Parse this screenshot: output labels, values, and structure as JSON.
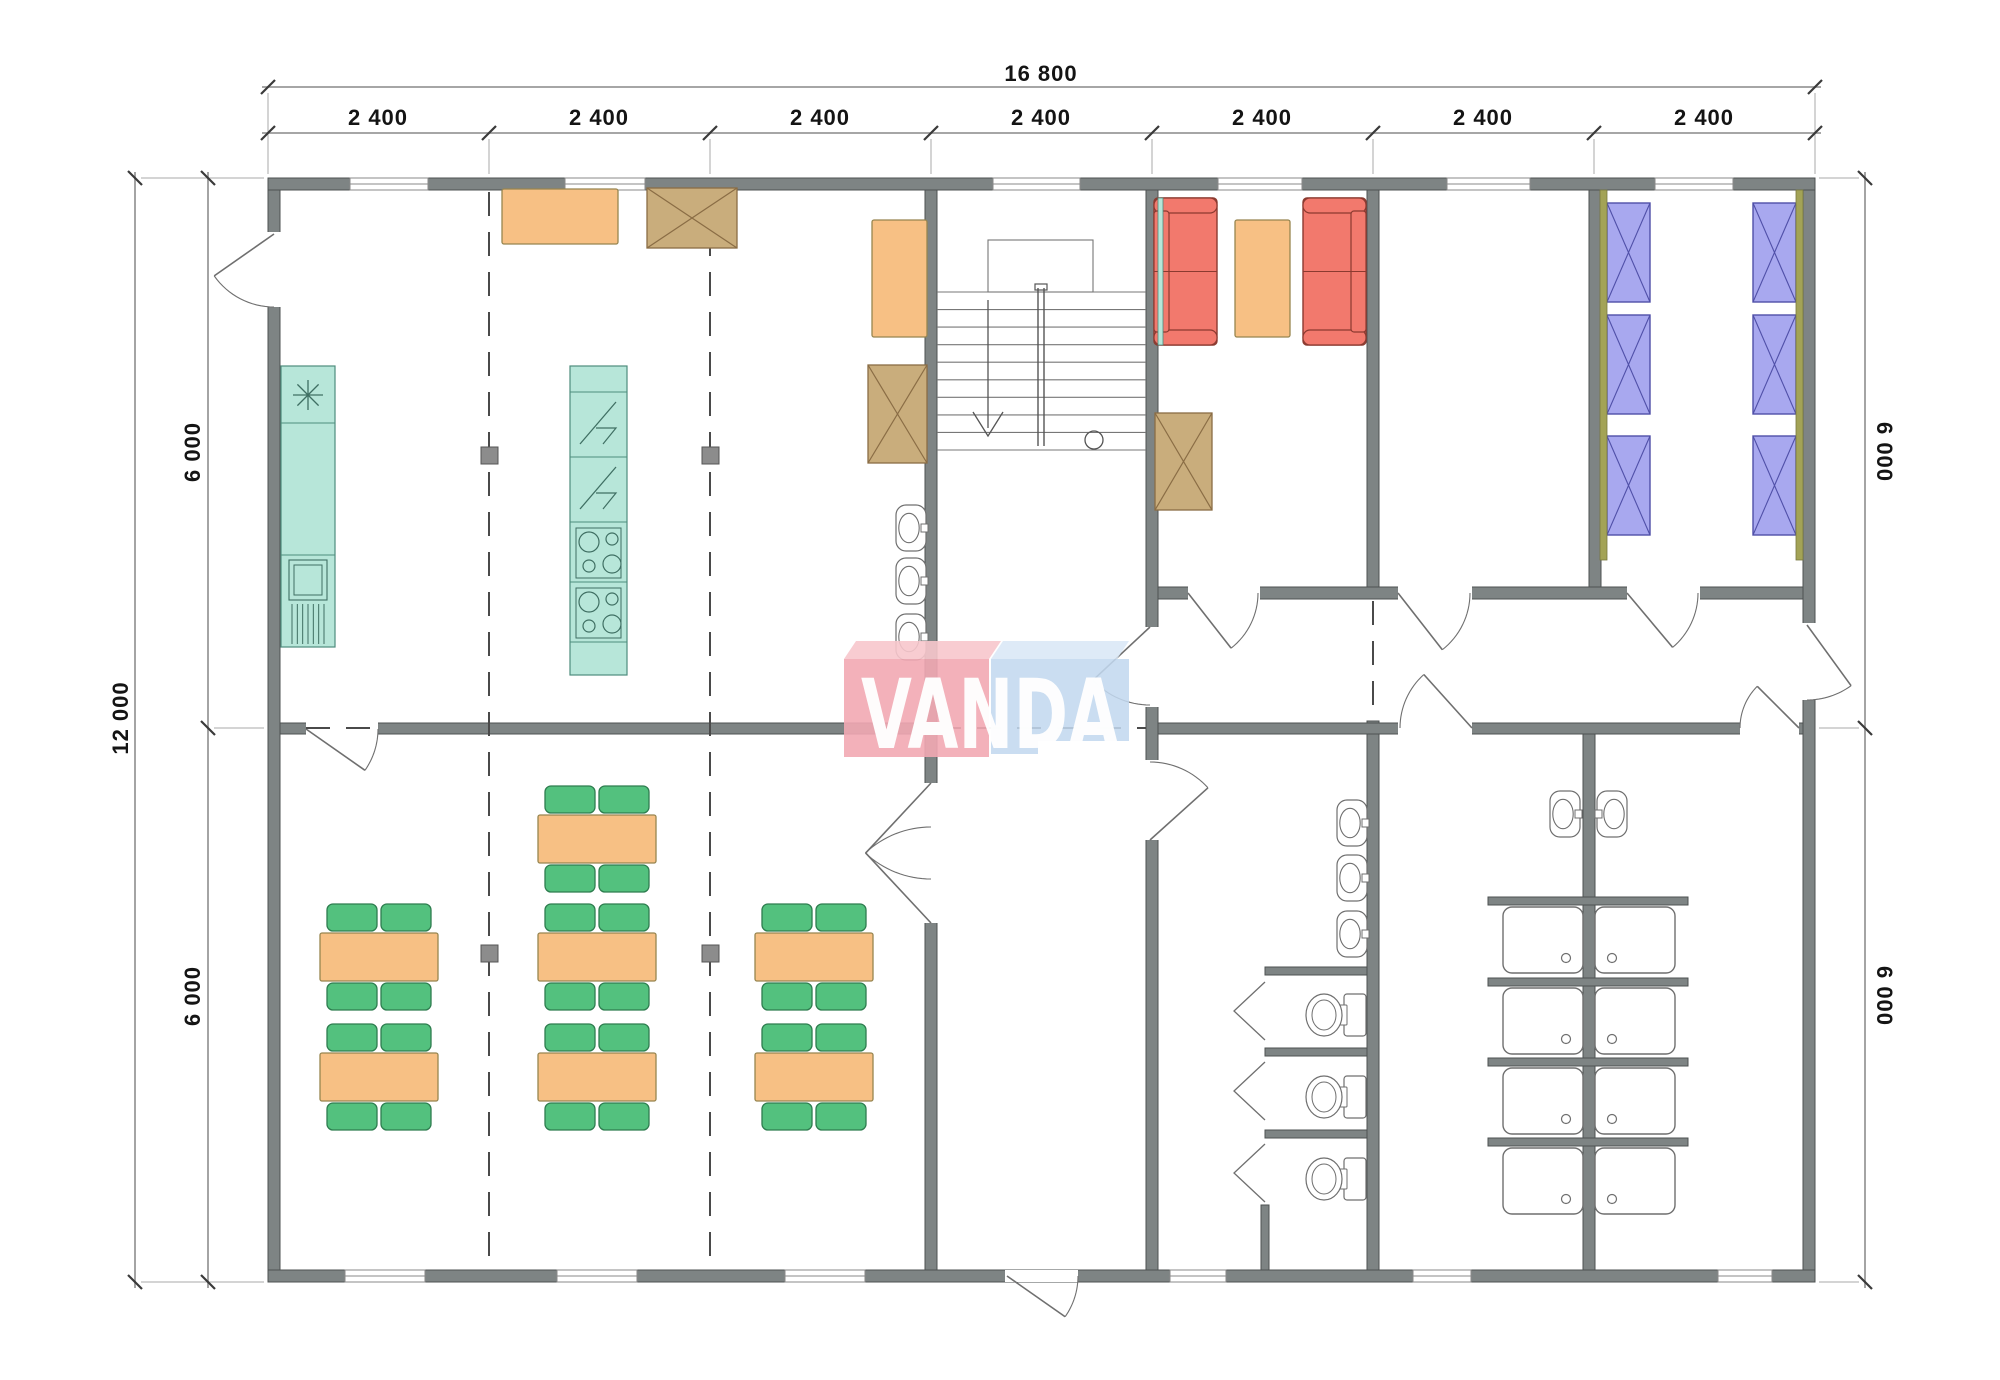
{
  "watermark": {
    "text": "VANDA",
    "pink": "#f2a9b2",
    "pink_top": "#f7c6cc",
    "blue": "#c2d8ef",
    "blue_top": "#d9e7f6",
    "letter_color": "#ffffff"
  },
  "dimensions": {
    "total_width": "16 800",
    "bays": [
      "2 400",
      "2 400",
      "2 400",
      "2 400",
      "2 400",
      "2 400",
      "2 400"
    ],
    "total_height": "12 000",
    "halves": [
      "6 000",
      "6 000",
      "6 000",
      "6 000"
    ]
  },
  "colors": {
    "wall": "#7e8484",
    "wall_stroke": "#4d5252",
    "fixture": "#6f6f6f",
    "teal": "#b7e6d9",
    "teal_stroke": "#4e8d7d",
    "orange": "#f7c084",
    "orange_stroke": "#97854f",
    "green": "#53c17e",
    "green_stroke": "#2e7d4f",
    "red": "#f2796d",
    "red_stroke": "#8b3a30",
    "blue": "#a8a8ef",
    "blue_stroke": "#5050a8",
    "tan": "#c9ad7c",
    "tan_stroke": "#8a6d45",
    "olive": "#a3a356",
    "olive_stroke": "#77773f",
    "axis": "#4a4a4a",
    "marker": "#8c8c8c",
    "dim_line": "#9a9a9a",
    "dim_tick": "#3a3a3a",
    "witness": "#aaaaaa"
  },
  "plan": {
    "bg": [
      268,
      178,
      1547,
      1104
    ],
    "walls": [
      [
        268,
        178,
        1547,
        12
      ],
      [
        268,
        1270,
        1547,
        12
      ],
      [
        268,
        190,
        12,
        1080
      ],
      [
        1803,
        190,
        12,
        1080
      ],
      [
        925,
        190,
        12,
        1080
      ],
      [
        1146,
        190,
        12,
        1080
      ],
      [
        1367,
        190,
        12,
        409
      ],
      [
        1367,
        721,
        12,
        549
      ],
      [
        1589,
        190,
        12,
        409
      ],
      [
        1583,
        733,
        12,
        537
      ],
      [
        280,
        723,
        645,
        11
      ],
      [
        1158,
        587,
        645,
        12
      ],
      [
        1158,
        723,
        645,
        11
      ],
      [
        1265,
        967,
        102,
        8
      ],
      [
        1265,
        1048,
        102,
        8
      ],
      [
        1265,
        1130,
        102,
        8
      ],
      [
        1261,
        1205,
        8,
        65
      ],
      [
        1488,
        897,
        200,
        8
      ],
      [
        1488,
        978,
        200,
        8
      ],
      [
        1488,
        1058,
        200,
        8
      ],
      [
        1488,
        1138,
        200,
        8
      ]
    ],
    "gaps": [
      [
        266,
        232,
        16,
        75
      ],
      [
        1801,
        623,
        16,
        77
      ],
      [
        306,
        721,
        72,
        15
      ],
      [
        923,
        783,
        16,
        140
      ],
      [
        1144,
        627,
        16,
        80
      ],
      [
        1144,
        760,
        16,
        80
      ],
      [
        1188,
        585,
        72,
        16
      ],
      [
        1398,
        585,
        74,
        16
      ],
      [
        1627,
        585,
        73,
        16
      ],
      [
        1398,
        721,
        74,
        15
      ],
      [
        1740,
        721,
        59,
        15
      ],
      [
        1005,
        1270,
        73,
        12
      ]
    ],
    "windows": [
      [
        350,
        178,
        78,
        12
      ],
      [
        565,
        178,
        80,
        12
      ],
      [
        993,
        178,
        87,
        12
      ],
      [
        1218,
        178,
        84,
        12
      ],
      [
        1447,
        178,
        83,
        12
      ],
      [
        1655,
        178,
        78,
        12
      ],
      [
        345,
        1270,
        80,
        12
      ],
      [
        557,
        1270,
        80,
        12
      ],
      [
        785,
        1270,
        80,
        12
      ],
      [
        1170,
        1270,
        56,
        12
      ],
      [
        1413,
        1270,
        58,
        12
      ],
      [
        1718,
        1270,
        54,
        12
      ]
    ],
    "doors": [
      [
        274,
        234,
        73,
        90,
        145
      ],
      [
        306,
        729,
        72,
        0,
        35
      ],
      [
        931,
        783,
        96,
        90,
        133
      ],
      [
        931,
        923,
        96,
        -90,
        -133
      ],
      [
        1150,
        627,
        78,
        90,
        137
      ],
      [
        1150,
        840,
        78,
        -90,
        -42
      ],
      [
        1188,
        593,
        70,
        0,
        52
      ],
      [
        1398,
        593,
        72,
        0,
        52
      ],
      [
        1627,
        593,
        71,
        0,
        50
      ],
      [
        1472,
        728,
        72,
        180,
        228
      ],
      [
        1807,
        625,
        75,
        90,
        54
      ],
      [
        1799,
        728,
        59,
        180,
        225
      ],
      [
        1007,
        1276,
        71,
        0,
        35
      ]
    ],
    "axes": [
      [
        489,
        192,
        489,
        1268
      ],
      [
        710,
        192,
        710,
        1268
      ],
      [
        1373,
        601,
        1373,
        719
      ],
      [
        937,
        728,
        1146,
        728
      ],
      [
        306,
        728,
        378,
        728
      ]
    ],
    "markers": [
      [
        481,
        447
      ],
      [
        702,
        447
      ],
      [
        481,
        945
      ],
      [
        702,
        945
      ]
    ],
    "stairs": {
      "x1": 937,
      "x2": 1146,
      "flight_top": 292,
      "bottom": 450,
      "treads": 9,
      "landing": [
        988,
        240,
        105,
        52
      ],
      "stringer_x": 1041,
      "arrow_x": 988,
      "circle": [
        1094,
        440,
        9
      ]
    },
    "furniture": {
      "tables": [
        [
          320,
          933
        ],
        [
          320,
          1053
        ],
        [
          538,
          815
        ],
        [
          538,
          933
        ],
        [
          538,
          1053
        ],
        [
          755,
          933
        ],
        [
          755,
          1053
        ]
      ],
      "table_size": [
        118,
        48
      ],
      "chair_size": [
        50,
        27
      ],
      "orange_boxes": [
        [
          502,
          189,
          116,
          55
        ],
        [
          872,
          220,
          55,
          117
        ],
        [
          1235,
          220,
          55,
          117
        ]
      ],
      "xboxes": [
        [
          647,
          188,
          90,
          60
        ],
        [
          868,
          365,
          59,
          98
        ],
        [
          1155,
          413,
          57,
          97
        ]
      ],
      "sofas": [
        {
          "x": 1154,
          "y": 198,
          "back": "left"
        },
        {
          "x": 1303,
          "y": 198,
          "back": "right"
        }
      ],
      "sofa_size": [
        63,
        147
      ],
      "beds": [
        [
          1607,
          203
        ],
        [
          1607,
          315
        ],
        [
          1607,
          436
        ],
        [
          1753,
          203
        ],
        [
          1753,
          315
        ],
        [
          1753,
          436
        ]
      ],
      "bed_size": [
        43,
        99
      ],
      "olive_strips": [
        [
          1600,
          190,
          7,
          370
        ],
        [
          1796,
          190,
          7,
          370
        ]
      ],
      "teal_strips": [
        [
          1158,
          198,
          5,
          147
        ]
      ],
      "counter": {
        "x": 281,
        "y": 366,
        "w": 54,
        "h": 281,
        "div": [
          423,
          555
        ],
        "ast": [
          308,
          395,
          15
        ],
        "app": [
          289,
          560,
          38,
          40
        ],
        "hatch": [
          292,
          324,
          604,
          644,
          6
        ]
      },
      "unit": {
        "x": 570,
        "y": 366,
        "w": 57,
        "h": 309,
        "div": [
          392,
          457,
          522,
          582,
          642
        ],
        "bolt_sections": [
          392,
          457
        ],
        "cook_sections": [
          522,
          582
        ]
      },
      "basins": [
        {
          "x": 896,
          "y": 505,
          "tap": "r"
        },
        {
          "x": 896,
          "y": 558,
          "tap": "r"
        },
        {
          "x": 896,
          "y": 614,
          "tap": "r"
        },
        {
          "x": 1337,
          "y": 800,
          "tap": "r"
        },
        {
          "x": 1337,
          "y": 855,
          "tap": "r"
        },
        {
          "x": 1337,
          "y": 911,
          "tap": "r"
        },
        {
          "x": 1550,
          "y": 791,
          "tap": "r"
        },
        {
          "x": 1597,
          "y": 791,
          "tap": "l"
        }
      ],
      "basin_size": [
        30,
        46
      ],
      "toilets": [
        [
          1305,
          993
        ],
        [
          1305,
          1075
        ],
        [
          1305,
          1157
        ]
      ],
      "showers": [
        {
          "x": 1503,
          "y": 907,
          "d": "r"
        },
        {
          "x": 1503,
          "y": 988,
          "d": "r"
        },
        {
          "x": 1503,
          "y": 1068,
          "d": "r"
        },
        {
          "x": 1503,
          "y": 1148,
          "d": "r"
        },
        {
          "x": 1595,
          "y": 907,
          "d": "l"
        },
        {
          "x": 1595,
          "y": 988,
          "d": "l"
        },
        {
          "x": 1595,
          "y": 1068,
          "d": "l"
        },
        {
          "x": 1595,
          "y": 1148,
          "d": "l"
        }
      ],
      "shower_size": [
        80,
        66
      ],
      "stall_doors": [
        [
          1265,
          982,
          1234,
          1011,
          1265,
          1040
        ],
        [
          1265,
          1062,
          1234,
          1091,
          1265,
          1120
        ],
        [
          1265,
          1144,
          1234,
          1173,
          1265,
          1202
        ]
      ]
    },
    "dim": {
      "lines": [
        [
          262,
          87,
          1821,
          87
        ],
        [
          262,
          133,
          1821,
          133
        ],
        [
          135,
          172,
          135,
          1288
        ],
        [
          208,
          172,
          208,
          1288
        ],
        [
          1865,
          172,
          1865,
          1288
        ]
      ],
      "hticks": [
        [
          268,
          87
        ],
        [
          1815,
          87
        ],
        [
          268,
          133
        ],
        [
          489,
          133
        ],
        [
          710,
          133
        ],
        [
          931,
          133
        ],
        [
          1152,
          133
        ],
        [
          1373,
          133
        ],
        [
          1594,
          133
        ],
        [
          1815,
          133
        ]
      ],
      "vticks": [
        [
          135,
          178
        ],
        [
          135,
          1282
        ],
        [
          208,
          178
        ],
        [
          208,
          728
        ],
        [
          208,
          1282
        ],
        [
          1865,
          178
        ],
        [
          1865,
          728
        ],
        [
          1865,
          1282
        ]
      ],
      "witness": [
        [
          268,
          93,
          268,
          174
        ],
        [
          1815,
          93,
          1815,
          174
        ],
        [
          489,
          139,
          489,
          174
        ],
        [
          710,
          139,
          710,
          174
        ],
        [
          931,
          139,
          931,
          174
        ],
        [
          1152,
          139,
          1152,
          174
        ],
        [
          1373,
          139,
          1373,
          174
        ],
        [
          1594,
          139,
          1594,
          174
        ],
        [
          141,
          178,
          264,
          178
        ],
        [
          141,
          1282,
          264,
          1282
        ],
        [
          214,
          728,
          264,
          728
        ],
        [
          1819,
          178,
          1859,
          178
        ],
        [
          1819,
          728,
          1859,
          728
        ],
        [
          1819,
          1282,
          1859,
          1282
        ]
      ]
    },
    "wm_shapes": {
      "pink_top": [
        [
          856,
          641
        ],
        [
          1001,
          641
        ],
        [
          989,
          659
        ],
        [
          844,
          659
        ]
      ],
      "pink_main": [
        [
          844,
          659
        ],
        [
          989,
          659
        ],
        [
          989,
          757
        ],
        [
          844,
          757
        ]
      ],
      "blue_top": [
        [
          1003,
          641
        ],
        [
          1129,
          641
        ],
        [
          1117,
          659
        ],
        [
          991,
          659
        ]
      ],
      "blue_main": [
        [
          991,
          659
        ],
        [
          1129,
          659
        ],
        [
          1129,
          741
        ],
        [
          991,
          741
        ]
      ],
      "blue_foot": [
        [
          991,
          741
        ],
        [
          1038,
          741
        ],
        [
          1038,
          754
        ],
        [
          991,
          754
        ]
      ],
      "text_x": 990,
      "text_y": 748,
      "text_len": 258
    }
  }
}
